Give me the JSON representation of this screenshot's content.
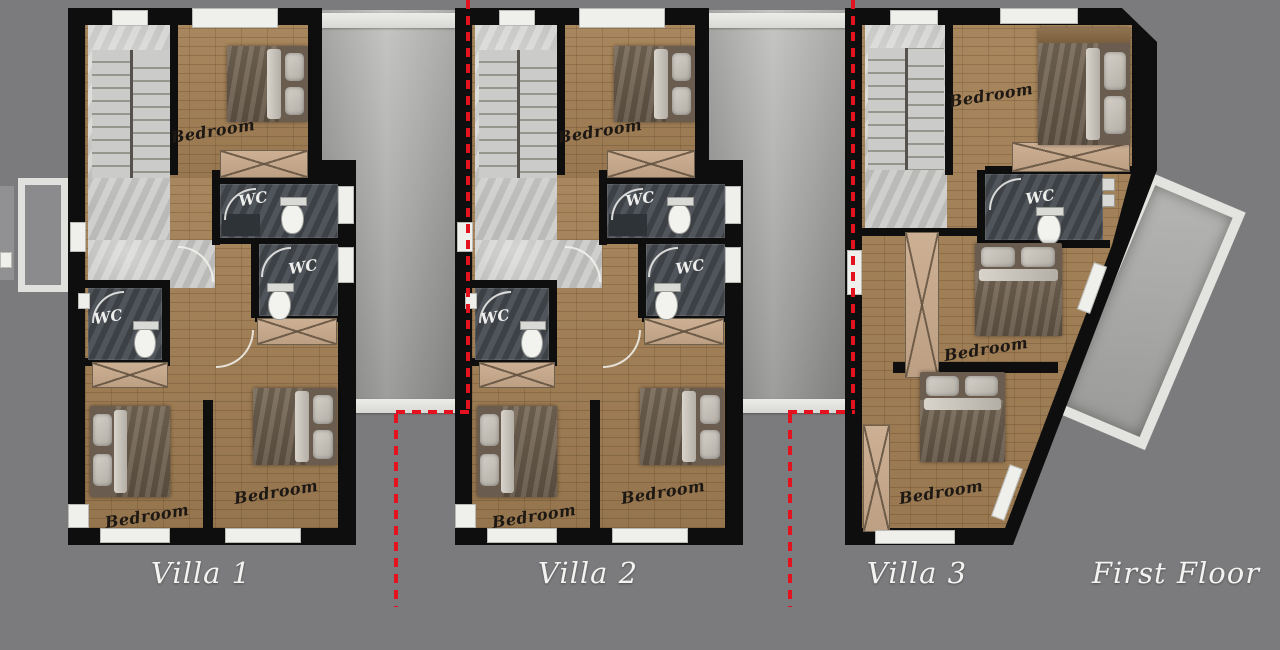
{
  "title": "First Floor villa plans",
  "floor_label": "First Floor",
  "villas": [
    {
      "name": "Villa 1",
      "bedroom_labels": [
        "Bedroom",
        "Bedroom",
        "Bedroom"
      ],
      "wc_labels": [
        "WC",
        "WC",
        "WC"
      ]
    },
    {
      "name": "Villa 2",
      "bedroom_labels": [
        "Bedroom",
        "Bedroom",
        "Bedroom"
      ],
      "wc_labels": [
        "WC",
        "WC",
        "WC"
      ]
    },
    {
      "name": "Villa 3",
      "bedroom_labels": [
        "Bedroom",
        "Bedroom",
        "Bedroom"
      ],
      "wc_labels": [
        "WC"
      ]
    }
  ],
  "colors": {
    "background": "#7b7b7d",
    "wall": "#0e0e0e",
    "wood_floor": "#a9875e",
    "marble_floor": "#c3c3c1",
    "wc_floor": "#474c52",
    "furniture_tan": "#cdb094",
    "divider_strip": "#b6b6b4",
    "boundary_red": "#e4121f",
    "label_white": "#f3f3f1"
  }
}
